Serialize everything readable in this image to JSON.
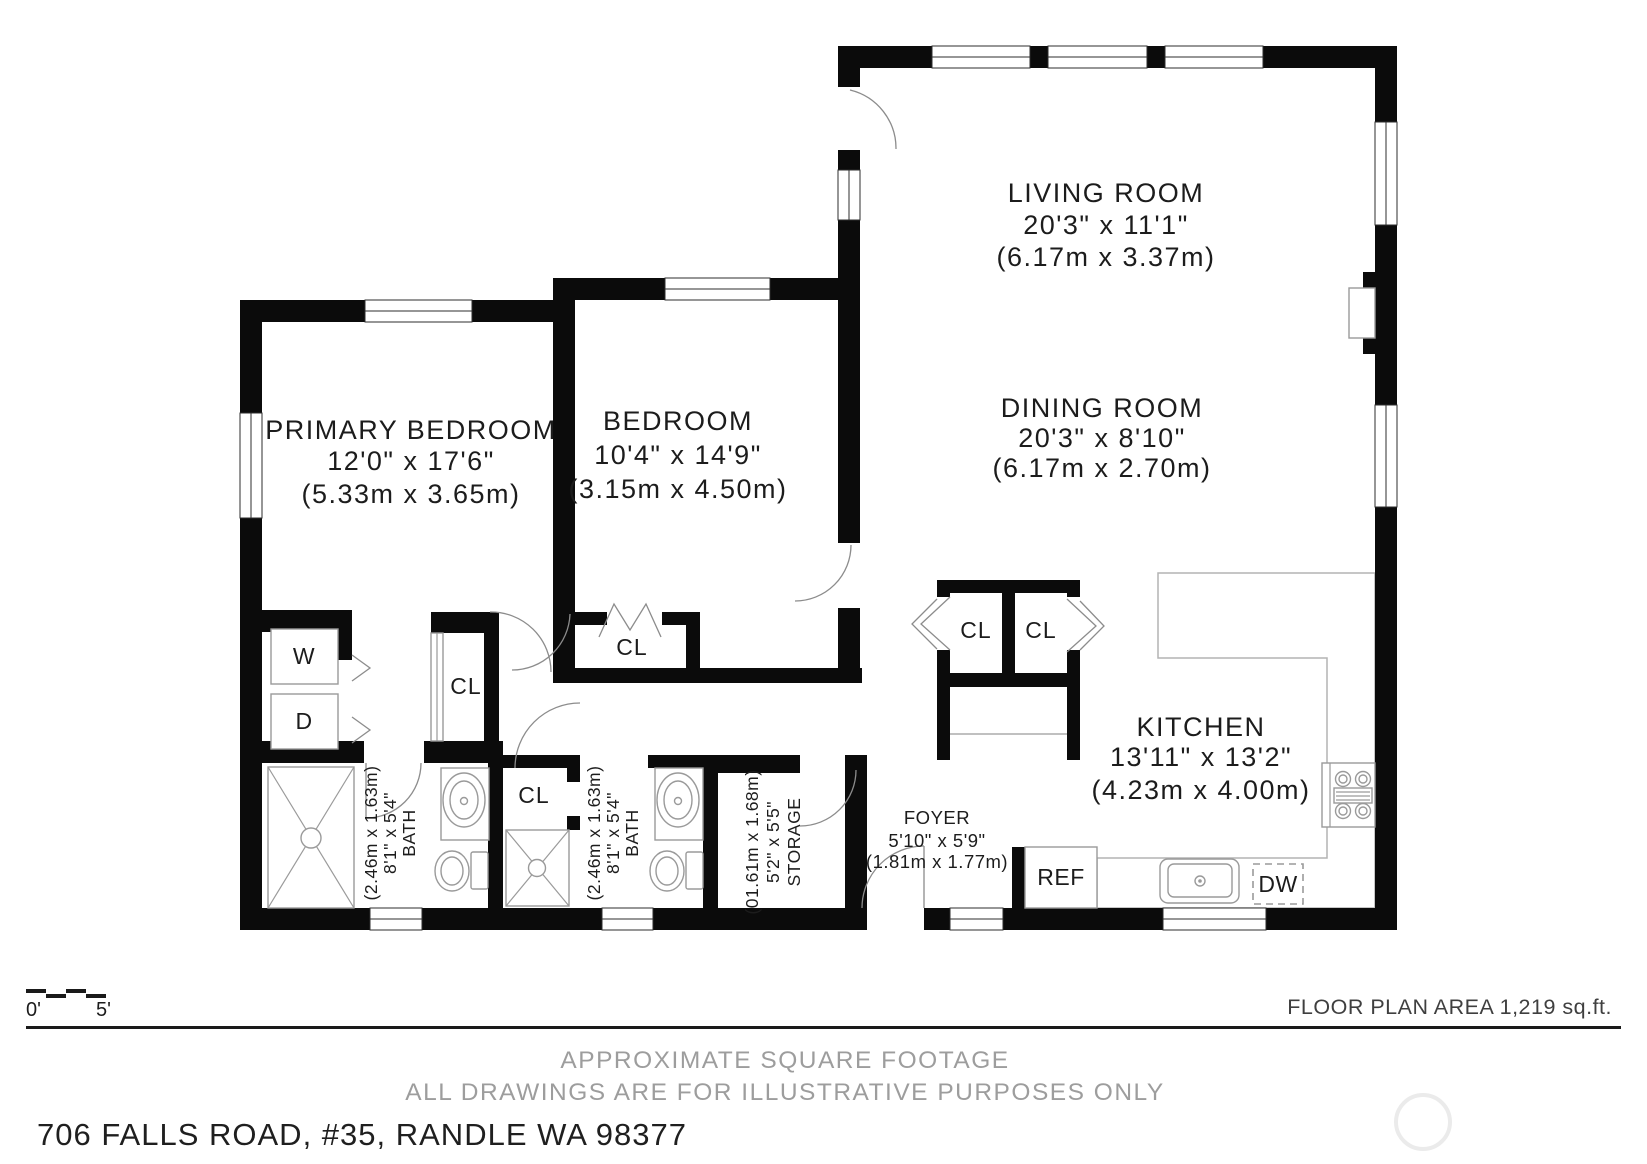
{
  "rooms": {
    "living": {
      "name": "LIVING ROOM",
      "dims_ft": "20'3\" x 11'1\"",
      "dims_m": "(6.17m x 3.37m)"
    },
    "dining": {
      "name": "DINING ROOM",
      "dims_ft": "20'3\" x 8'10\"",
      "dims_m": "(6.17m x 2.70m)"
    },
    "kitchen": {
      "name": "KITCHEN",
      "dims_ft": "13'11\" x 13'2\"",
      "dims_m": "(4.23m x 4.00m)"
    },
    "primary": {
      "name": "PRIMARY BEDROOM",
      "dims_ft": "12'0\" x 17'6\"",
      "dims_m": "(5.33m x 3.65m)"
    },
    "bedroom": {
      "name": "BEDROOM",
      "dims_ft": "10'4\" x 14'9\"",
      "dims_m": "(3.15m x 4.50m)"
    },
    "bath1": {
      "name": "BATH",
      "dims_ft": "8'1\" x 5'4\"",
      "dims_m": "(2.46m x 1.63m)"
    },
    "bath2": {
      "name": "BATH",
      "dims_ft": "8'1\" x 5'4\"",
      "dims_m": "(2.46m x 1.63m)"
    },
    "storage": {
      "name": "STORAGE",
      "dims_ft": "5'2\" x 5'5\"",
      "dims_m": "(01.61m x 1.68m)"
    },
    "foyer": {
      "name": "FOYER",
      "dims_ft": "5'10\" x 5'9\"",
      "dims_m": "(1.81m x 1.77m)"
    }
  },
  "labels": {
    "closet": "CL",
    "washer": "W",
    "dryer": "D",
    "refrigerator": "REF",
    "dishwasher": "DW"
  },
  "scale_bar": {
    "start": "0'",
    "end": "5'"
  },
  "footer": {
    "area_note": "FLOOR PLAN AREA 1,219 sq.ft.",
    "disclaimer1": "APPROXIMATE SQUARE FOOTAGE",
    "disclaimer2": "ALL DRAWINGS ARE FOR ILLUSTRATIVE PURPOSES ONLY",
    "address": "706 FALLS ROAD, #35, RANDLE WA 98377"
  },
  "colors": {
    "wall": "#0b0b0b",
    "fixture_stroke": "#9a9a9a",
    "door_stroke": "#8c8c8c",
    "muted_text": "#9d9d9d",
    "area_text": "#3f3f3f"
  }
}
